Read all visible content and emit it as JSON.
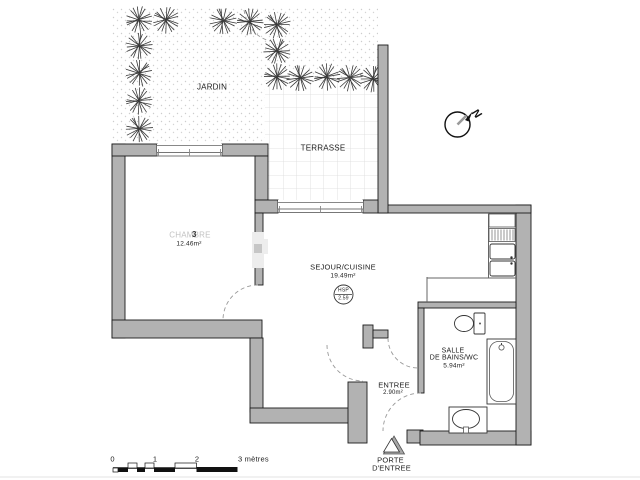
{
  "rooms": {
    "jardin": {
      "name": "JARDIN"
    },
    "terrasse": {
      "name": "TERRASSE"
    },
    "chambre": {
      "name": "CHAMBRE",
      "area": "12.46m²"
    },
    "sejour_cuisine": {
      "name": "SEJOUR/CUISINE",
      "area": "19.49m²",
      "ceiling_label": "HSP",
      "ceiling_value": "2.59"
    },
    "salle_de_bains": {
      "name_line1": "SALLE",
      "name_line2": "DE BAINS/WC",
      "area": "5.94m²"
    },
    "entree": {
      "name": "ENTREE",
      "area": "2.90m²"
    },
    "porte_entree": {
      "name_line1": "PORTE",
      "name_line2": "D'ENTREE"
    }
  },
  "compass": {
    "north_label": "N"
  },
  "scale_bar": {
    "tick_0": "0",
    "tick_1": "1",
    "tick_2": "2",
    "end_label": "3 mètres"
  },
  "watermark": {
    "digit": "3"
  },
  "colors": {
    "wall_fill": "#b2b2b2",
    "wall_outline": "#1a1a1a",
    "tile_line": "#dadada",
    "label_dark": "#1c1c1c",
    "chambre_gray": "#c2c2c2",
    "dash_color": "#999999"
  }
}
